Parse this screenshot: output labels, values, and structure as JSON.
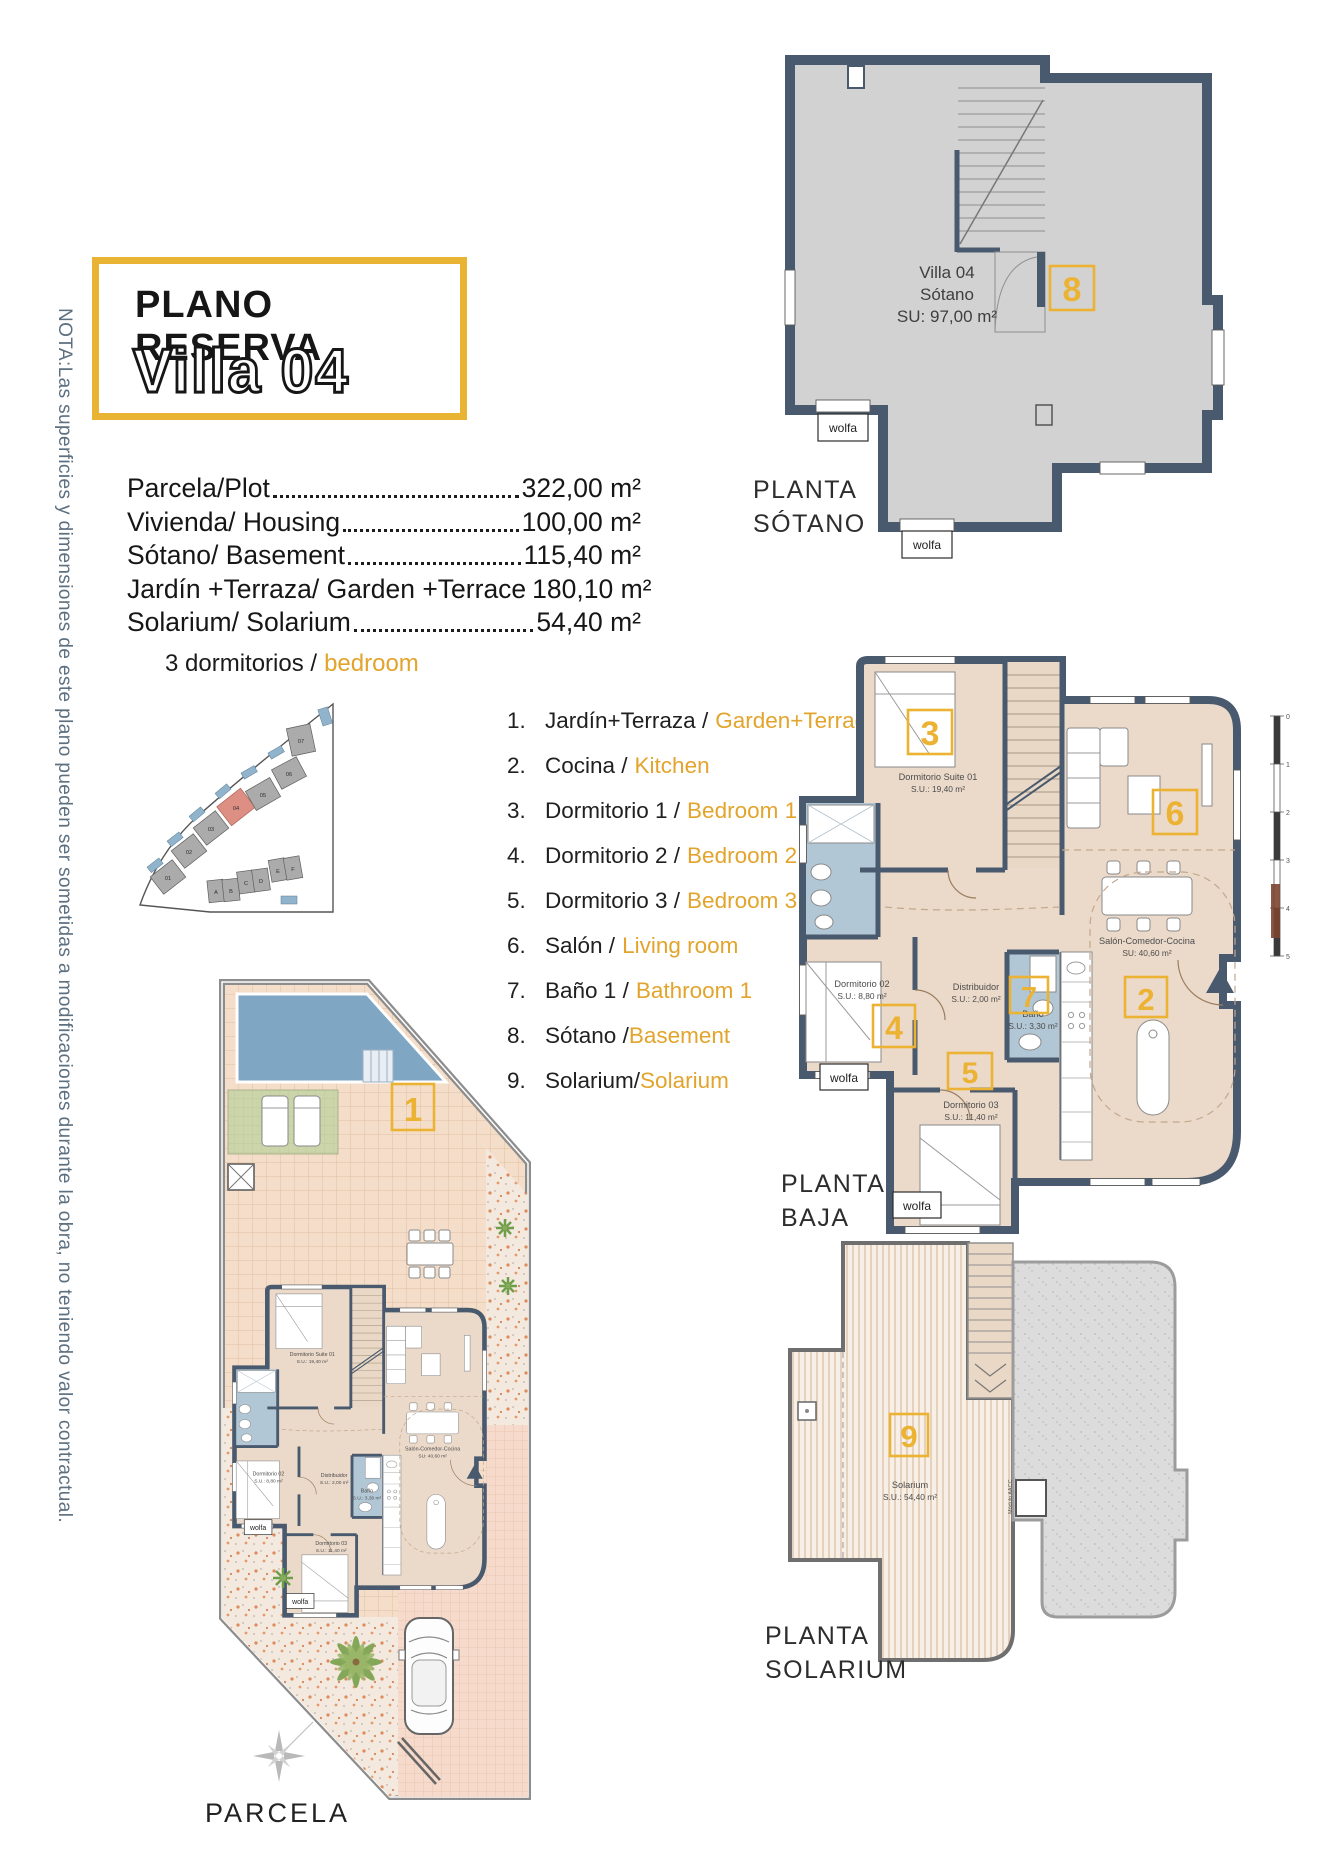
{
  "note": "NOTA:Las superficies y dimensiones de este plano pueden ser sometidas a modificaciones durante la obra, no teniendo valor contractual.",
  "title": {
    "kicker": "PLANO RESERVA",
    "name": "Villa 04"
  },
  "areas": {
    "rows": [
      {
        "label": "Parcela/Plot",
        "value": "322,00 m²"
      },
      {
        "label": "Vivienda/ Housing",
        "value": "100,00 m²"
      },
      {
        "label": "Sótano/ Basement",
        "value": "115,40 m²"
      },
      {
        "label": "Jardín +Terraza/ Garden +Terrace",
        "value": "180,10 m²"
      },
      {
        "label": "Solarium/ Solarium",
        "value": "54,40 m²"
      }
    ],
    "bedrooms_es": "3 dormitorios /",
    "bedrooms_en": "bedroom"
  },
  "legend": {
    "items": [
      {
        "num": "1.",
        "es": "Jardín+Terraza /",
        "en": "Garden+Terrace"
      },
      {
        "num": "2.",
        "es": "Cocina /",
        "en": "Kitchen"
      },
      {
        "num": "3.",
        "es": "Dormitorio 1 /",
        "en": "Bedroom 1"
      },
      {
        "num": "4.",
        "es": "Dormitorio 2 /",
        "en": "Bedroom 2"
      },
      {
        "num": "5.",
        "es": "Dormitorio 3 /",
        "en": "Bedroom 3"
      },
      {
        "num": "6.",
        "es": "Salón /",
        "en": "Living room"
      },
      {
        "num": "7.",
        "es": "Baño 1 /",
        "en": "Bathroom 1"
      },
      {
        "num": "8.",
        "es": "Sótano /",
        "en": "Basement"
      },
      {
        "num": "9.",
        "es": "Solarium/",
        "en": "Solarium"
      }
    ]
  },
  "site_map": {
    "plots": [
      "01",
      "02",
      "03",
      "04",
      "05",
      "06",
      "07"
    ],
    "blocks": [
      "A",
      "B",
      "C",
      "D",
      "E",
      "F"
    ],
    "highlighted_plot": "04"
  },
  "floors": {
    "sotano": {
      "title1": "PLANTA",
      "title2": "SÓTANO",
      "badge": "8",
      "label1": "Villa 04",
      "label2": "Sótano",
      "label3": "SU: 97,00 m²",
      "vent1": "wolfa",
      "vent2": "wolfa"
    },
    "baja": {
      "title1": "PLANTA",
      "title2": "BAJA",
      "badges": {
        "b2": "2",
        "b3": "3",
        "b4": "4",
        "b5": "5",
        "b6": "6",
        "b7": "7"
      },
      "rooms": {
        "suite": {
          "name": "Dormitorio Suite 01",
          "area": "S.U.: 19,40 m²"
        },
        "dorm2": {
          "name": "Dormitorio 02",
          "area": "S.U.: 8,80 m²"
        },
        "distribuidor": {
          "name": "Distribuidor",
          "area": "S.U.: 2,00 m²"
        },
        "bano": {
          "name": "Baño",
          "area": "S.U.: 3,30 m²"
        },
        "dorm3": {
          "name": "Dormitorio 03",
          "area": "S.U.: 11,40 m²"
        },
        "salon": {
          "name": "Salón-Comedor-Cocina",
          "area": "SU: 40,60 m²"
        }
      },
      "vent1": "wolfa",
      "vent2": "wolfa"
    },
    "solarium": {
      "title1": "PLANTA",
      "title2": "SOLARIUM",
      "badge": "9",
      "room": "Solarium",
      "area": "S.U.: 54,40 m²",
      "module": "Módulo AACC"
    },
    "parcela": {
      "title": "PARCELA",
      "badge": "1"
    }
  },
  "scale_bar": {
    "ticks": [
      "0",
      "1",
      "2",
      "3",
      "4",
      "5"
    ]
  },
  "colors": {
    "accent": "#ECB233",
    "title_border": "#E9B334",
    "wall": "#4A5A6E",
    "floor": "#EBDACA",
    "bath": "#B2C7D5",
    "basement_floor": "#D2D2D2",
    "pool": "#7FA6C3",
    "lawn": "#CCD4A9",
    "deck": "#F8F0E6",
    "roof": "#DCDCDC",
    "note_text": "#5D7080"
  }
}
